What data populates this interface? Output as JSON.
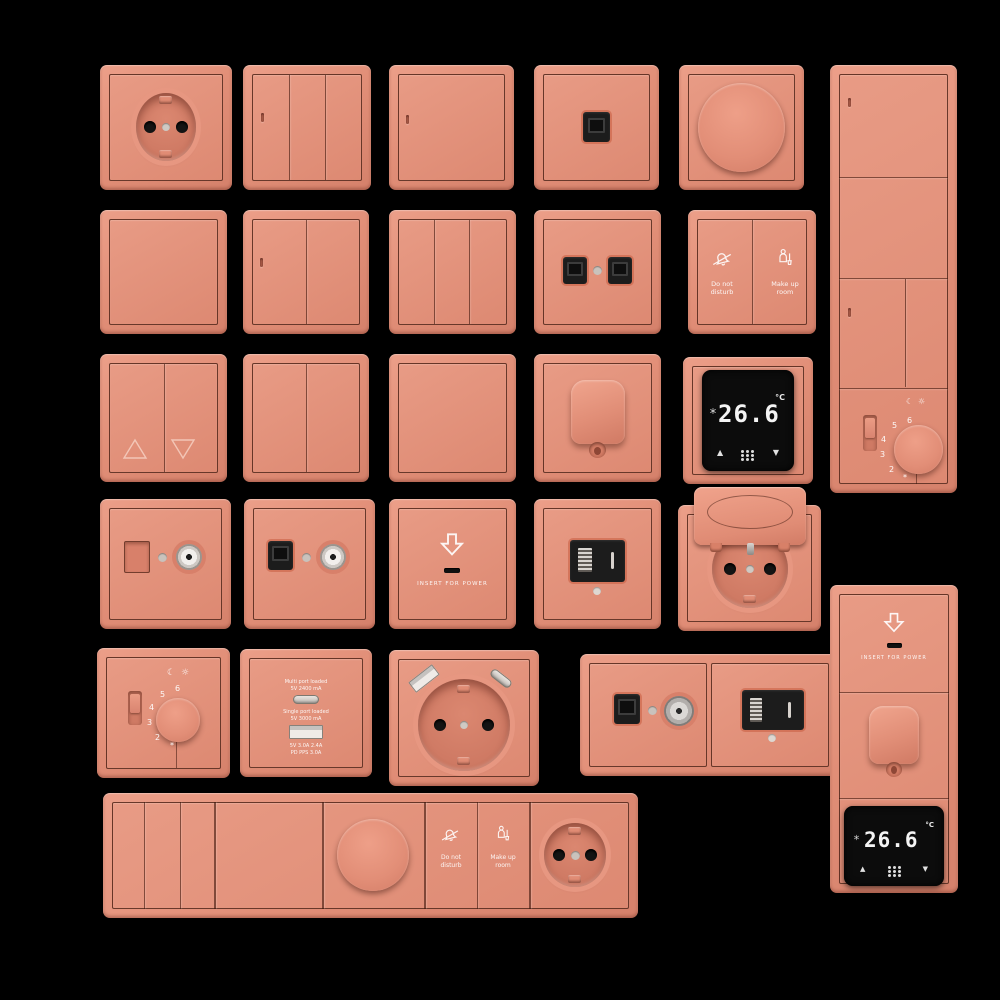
{
  "canvas": {
    "background": "#000000"
  },
  "palette": {
    "plate": "#e18e77",
    "plate_highlight": "#ec9f89",
    "plate_shadow": "#d5816b",
    "engraved_line": "#3e180e",
    "module_black": "#1c1c1c",
    "display_black": "#0c0c0c",
    "metal_grey": "#c9c2bc",
    "label_white": "#ffffff"
  },
  "text": {
    "do_not_disturb_line1": "Do not",
    "do_not_disturb_line2": "disturb",
    "make_up_room_line1": "Make up",
    "make_up_room_line2": "room",
    "insert_for_power": "INSERT FOR POWER",
    "thermostat_temp": "26.6",
    "thermostat_unit": "°C",
    "dial_number_6": "6",
    "dial_number_5": "5",
    "dial_number_4": "4",
    "dial_number_3": "3",
    "dial_number_2": "2",
    "dial_frost_mark": "*",
    "charger_line1": "Multi port loaded",
    "charger_line2": "5V 2400 mA",
    "charger_line3": "Single port loaded",
    "charger_line4": "5V 3000 mA",
    "charger_line5": "5V 3.0A 2.4A",
    "charger_line6": "PD PPS 3.0A"
  },
  "icons": {
    "up_triangle": "▲",
    "down_triangle": "▼",
    "moon": "☾",
    "sun": "☼"
  }
}
